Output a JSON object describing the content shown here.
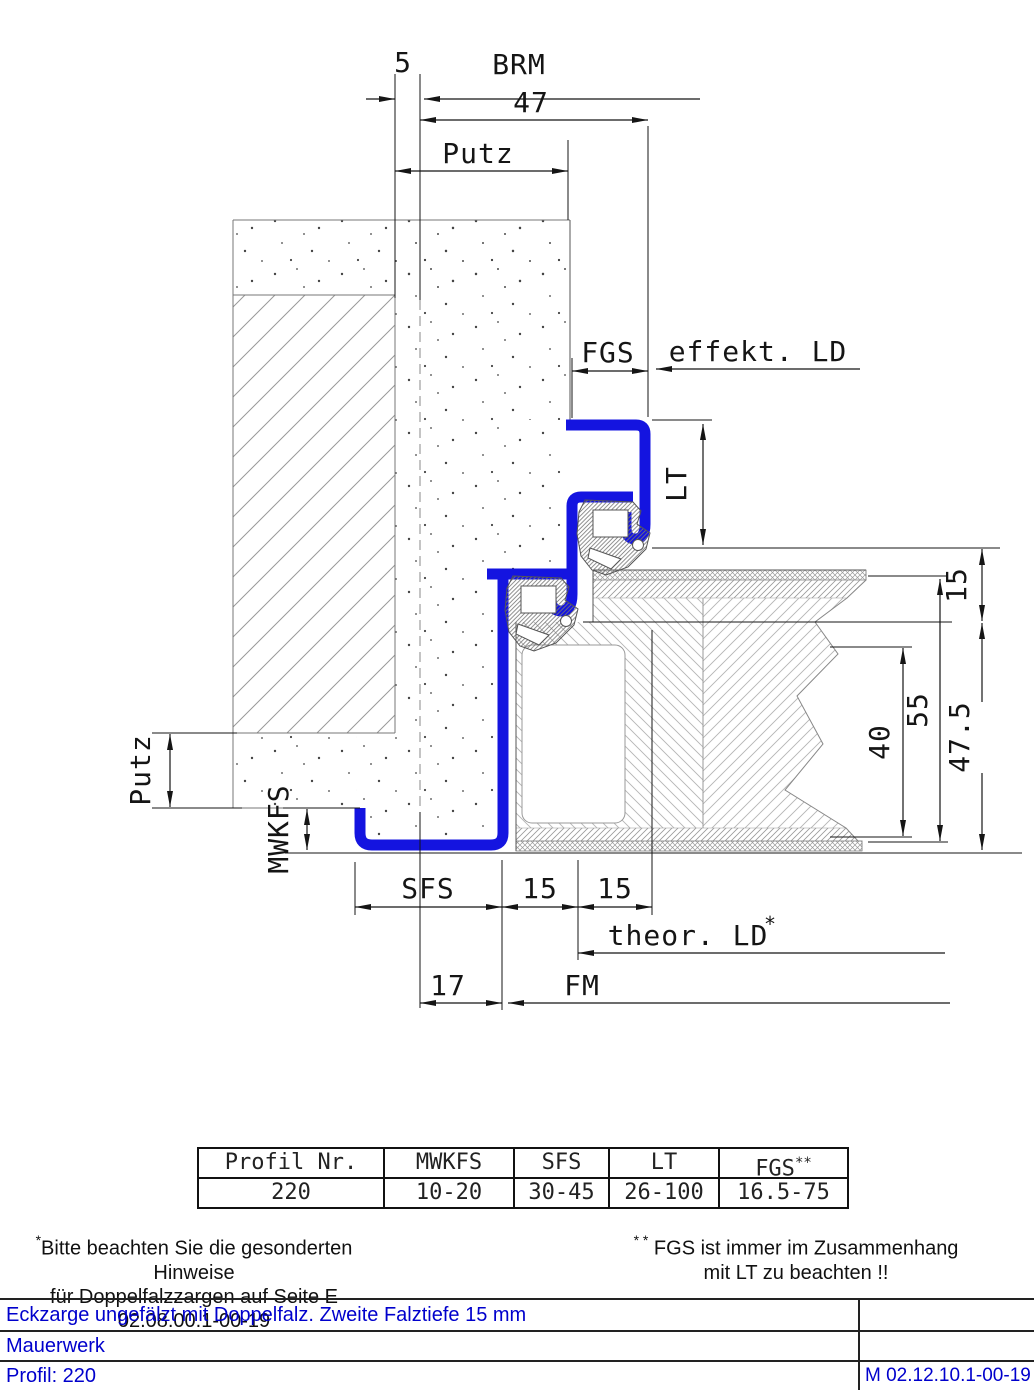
{
  "drawing": {
    "colors": {
      "frame_blue": "#1414e0",
      "line": "#151515",
      "hatch": "#999999"
    },
    "dim_labels": {
      "d5": "5",
      "brm": "BRM",
      "d47": "47",
      "putz_top": "Putz",
      "fgs": "FGS",
      "effekt_ld": "effekt. LD",
      "lt": "LT",
      "r15": "15",
      "r55": "55",
      "r40": "40",
      "r47_5": "47.5",
      "putz_left": "Putz",
      "mwkfs": "MWKFS",
      "sfs": "SFS",
      "b15a": "15",
      "b15b": "15",
      "theor_ld": "theor. LD",
      "theor_ld_star": "*",
      "d17": "17",
      "fm": "FM"
    }
  },
  "profile_table": {
    "headers": [
      "Profil Nr.",
      "MWKFS",
      "SFS",
      "LT",
      "FGS"
    ],
    "fgs_sup": "**",
    "values": [
      "220",
      "10-20",
      "30-45",
      "26-100",
      "16.5-75"
    ]
  },
  "footnotes": {
    "left_star": "*",
    "left_line1": "Bitte beachten Sie die gesonderten Hinweise",
    "left_line2": "für Doppelfalzzargen auf Seite E 02.08.00.1-00-19",
    "right_star": "* *",
    "right_line1": "FGS ist immer im Zusammenhang",
    "right_line2": "mit LT zu beachten !!"
  },
  "title_block": {
    "row1": "Eckzarge ungefälzt mit Doppelfalz. Zweite Falztiefe 15 mm",
    "row2": "Mauerwerk",
    "row3": "Profil: 220",
    "doc_number": "M 02.12.10.1-00-19",
    "text_color": "#0000cc"
  }
}
